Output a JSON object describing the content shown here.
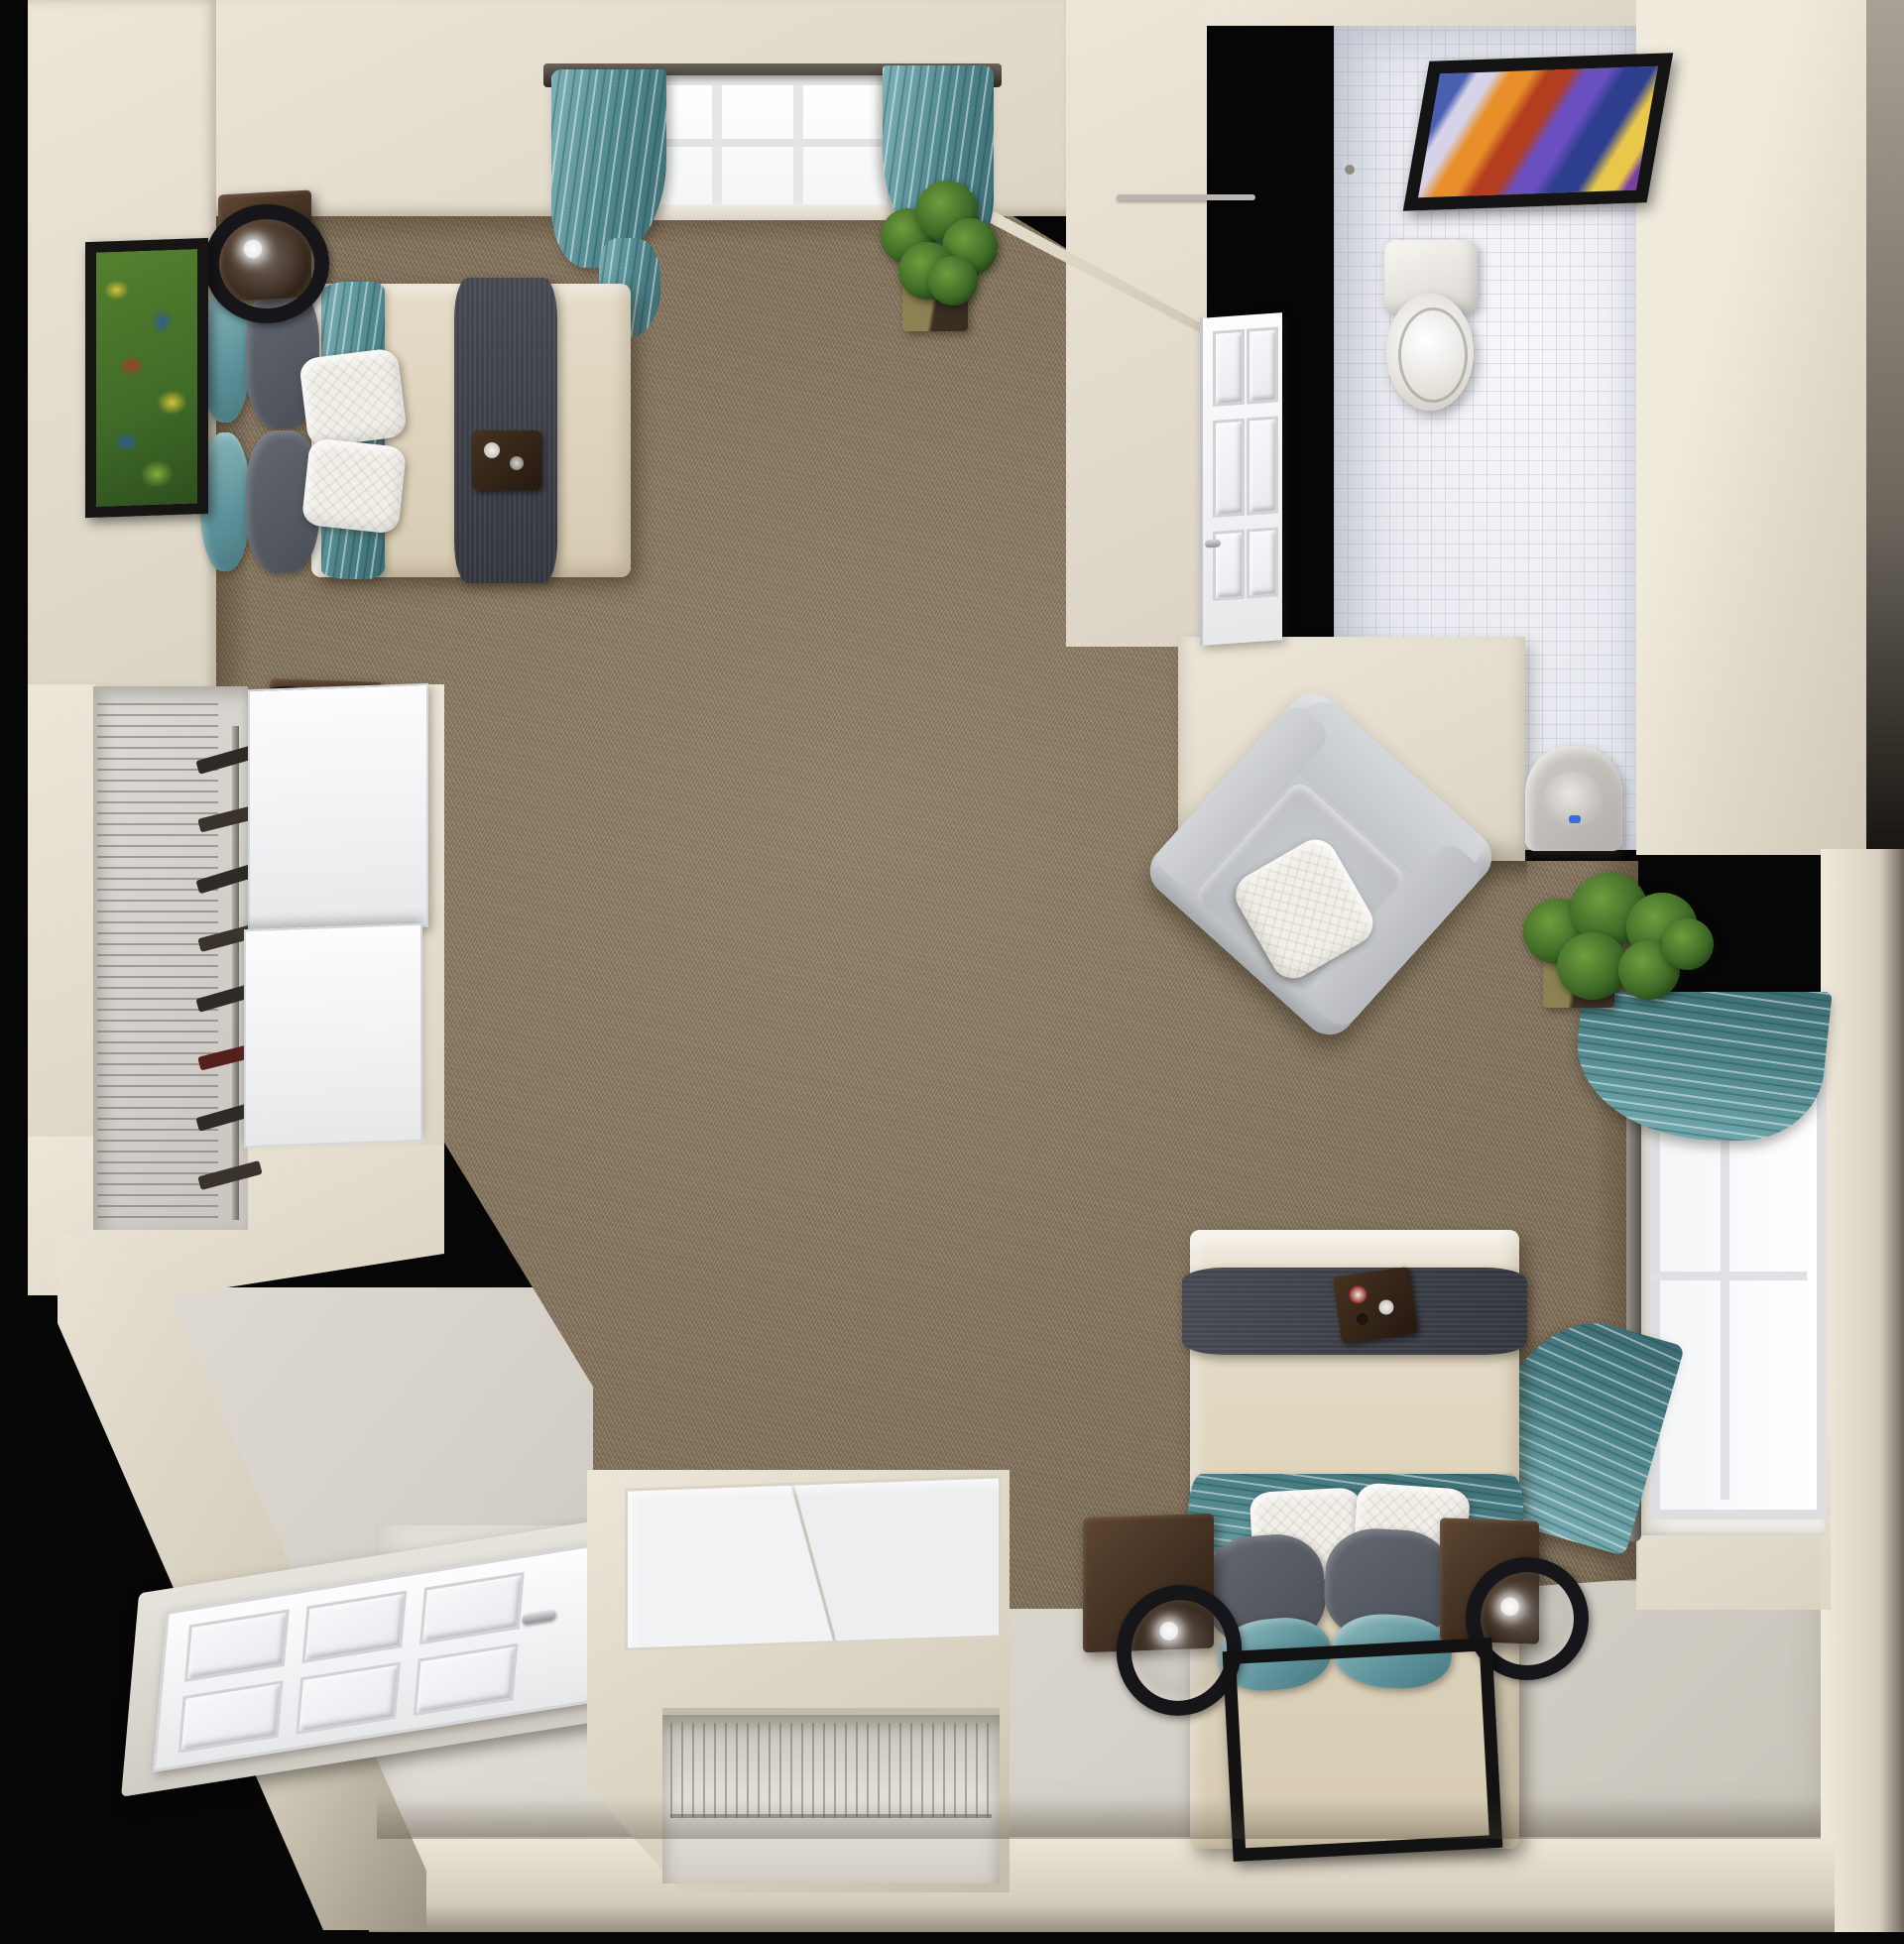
{
  "scene": {
    "type": "3d-rendered floor plan",
    "view": "top-down dollhouse view",
    "subject": "studio apartment with two beds, bathroom, closets and entry",
    "background": "#060606"
  },
  "palette": {
    "wall": "#ece6d8",
    "wallShade": "#dcd5c5",
    "carpet": "#87765e",
    "tile": "#eef0f4",
    "entryFloor": "#dcd8d0",
    "teal": "#4e858c",
    "tealLight": "#8fbcc1",
    "bedBeige": "#ddd3bf",
    "runnerGray": "#3b3e46",
    "woodDark": "#3d2c1e",
    "chairGray": "#c6c9cd",
    "frameBlack": "#141414",
    "doorWhite": "#f5f6f8"
  },
  "rooms": [
    {
      "id": "main-room",
      "label": "Main living and sleeping area",
      "floor": "brown carpet"
    },
    {
      "id": "bathroom",
      "label": "Bathroom",
      "floor": "white tile"
    },
    {
      "id": "closet",
      "label": "Closet with wire shelving",
      "floor": "light"
    },
    {
      "id": "entry",
      "label": "Entry",
      "floor": "vinyl"
    }
  ],
  "furniture": [
    {
      "id": "bed-1",
      "label": "Bed with beige comforter, dark runner and teal accent pillows"
    },
    {
      "id": "bed-2",
      "label": "Second bed with beige comforter, dark runner and teal accent pillows"
    },
    {
      "id": "armchair",
      "label": "Gray armchair with white throw pillow"
    },
    {
      "id": "nightstand",
      "label": "Dark wood nightstand"
    },
    {
      "id": "table-lamp",
      "label": "Black drum table lamp"
    },
    {
      "id": "toilet",
      "label": "Toilet"
    },
    {
      "id": "sink",
      "label": "Bathroom sink"
    },
    {
      "id": "wardrobe",
      "label": "Wardrobe cabinet with wire shelf"
    },
    {
      "id": "closet-shelving",
      "label": "Wire closet shelving and shoe tower"
    },
    {
      "id": "entry-door",
      "label": "White six-panel entry door"
    },
    {
      "id": "bathroom-door",
      "label": "White six-panel bathroom door"
    },
    {
      "id": "window",
      "label": "Window with white frame"
    },
    {
      "id": "curtain",
      "label": "Teal patterned curtain"
    },
    {
      "id": "plant",
      "label": "Potted green plant"
    },
    {
      "id": "rug",
      "label": "Framed multicolor area rug"
    },
    {
      "id": "artwork",
      "label": "Framed wall art"
    }
  ]
}
